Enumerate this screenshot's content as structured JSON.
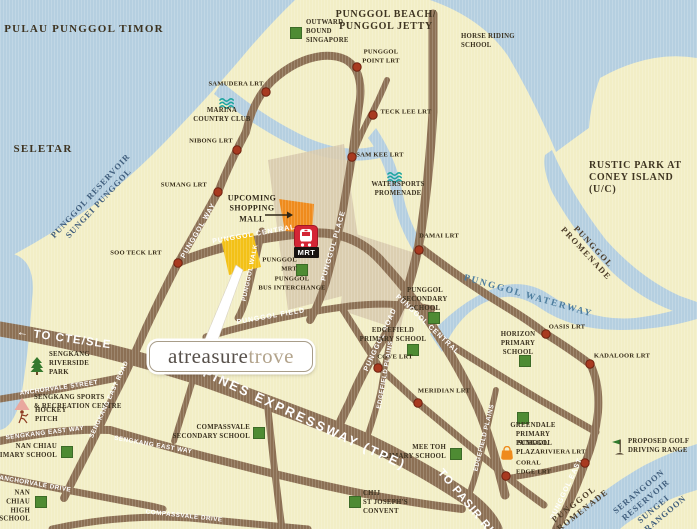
{
  "logo": {
    "part1": "atreasure",
    "part2": "trove"
  },
  "mrt_badge": "MRT",
  "colors": {
    "water": "#b5cfe0",
    "land": "#f2eec6",
    "road": "#8c7054",
    "town_block": "#d9cbae",
    "site_yellow": "#f3c117",
    "mall_orange": "#ef8b1d",
    "lrt_red": "#a83a20",
    "school_green": "#4e8b33",
    "mrt_red": "#d42535",
    "logo_text": "#57504a",
    "logo_trove": "#b3a48c"
  },
  "labels": [
    {
      "id": "pulau-punggol-timor",
      "text": "PULAU PUNGGOL TIMOR",
      "x": 84,
      "y": 30,
      "rotate": 0,
      "cls": "place-lg",
      "align": "center"
    },
    {
      "id": "punggol-beach-jetty",
      "text": "PUNGGOL BEACH/\nPUNGGOL JETTY",
      "x": 386,
      "y": 21,
      "rotate": 0,
      "cls": "place-md",
      "align": "center"
    },
    {
      "id": "outward-bound",
      "text": "OUTWARD\nBOUND\nSINGAPORE",
      "x": 306,
      "y": 32,
      "rotate": 0,
      "cls": "poi",
      "align": "left"
    },
    {
      "id": "horse-riding-school",
      "text": "HORSE RIDING\nSCHOOL",
      "x": 461,
      "y": 42,
      "rotate": 0,
      "cls": "poi",
      "align": "left"
    },
    {
      "id": "punggol-point-lrt",
      "text": "PUNGGOL\nPOINT LRT",
      "x": 381,
      "y": 57,
      "rotate": 0,
      "cls": "lrt",
      "align": "center"
    },
    {
      "id": "samudera-lrt",
      "text": "SAMUDERA LRT",
      "x": 236,
      "y": 85,
      "rotate": 0,
      "cls": "lrt",
      "align": "center"
    },
    {
      "id": "marina-country-club",
      "text": "MARINA\nCOUNTRY CLUB",
      "x": 222,
      "y": 116,
      "rotate": 0,
      "cls": "poi",
      "align": "center"
    },
    {
      "id": "teck-lee-lrt",
      "text": "TECK LEE LRT",
      "x": 406,
      "y": 113,
      "rotate": 0,
      "cls": "lrt",
      "align": "center"
    },
    {
      "id": "nibong-lrt",
      "text": "NIBONG LRT",
      "x": 211,
      "y": 142,
      "rotate": 0,
      "cls": "lrt",
      "align": "center"
    },
    {
      "id": "sam-kee-lrt",
      "text": "SAM KEE LRT",
      "x": 380,
      "y": 156,
      "rotate": 0,
      "cls": "lrt",
      "align": "center"
    },
    {
      "id": "seletar",
      "text": "SELETAR",
      "x": 43,
      "y": 150,
      "rotate": 0,
      "cls": "place-lg",
      "align": "center"
    },
    {
      "id": "rustic-park-coney",
      "text": "RUSTIC PARK AT\nCONEY ISLAND\n(U/C)",
      "x": 589,
      "y": 178,
      "rotate": 0,
      "cls": "place-md",
      "align": "left"
    },
    {
      "id": "punggol-reservoir",
      "text": "PUNGGOL RESERVOIR\nSUNGEI PUNGGOL",
      "x": 95,
      "y": 200,
      "rotate": -47,
      "cls": "water",
      "align": "center"
    },
    {
      "id": "sumang-lrt",
      "text": "SUMANG LRT",
      "x": 207,
      "y": 186,
      "rotate": 0,
      "cls": "lrt",
      "align": "right"
    },
    {
      "id": "watersports-promenade",
      "text": "WATERSPORTS\nPROMENADE",
      "x": 398,
      "y": 190,
      "rotate": 0,
      "cls": "poi",
      "align": "center"
    },
    {
      "id": "upcoming-mall",
      "text": "UPCOMING\nSHOPPING\nMALL",
      "x": 252,
      "y": 209,
      "rotate": 0,
      "cls": "poi-lg",
      "align": "center"
    },
    {
      "id": "punggol-way-road",
      "text": "PUNGGOL WAY",
      "x": 199,
      "y": 231,
      "rotate": -60,
      "cls": "road",
      "align": "center"
    },
    {
      "id": "punggol-central-road-1",
      "text": "PUNGGOL CENTRAL",
      "x": 254,
      "y": 235,
      "rotate": -10,
      "cls": "road",
      "align": "center"
    },
    {
      "id": "soo-teck-lrt",
      "text": "SOO TECK LRT",
      "x": 136,
      "y": 254,
      "rotate": 0,
      "cls": "lrt",
      "align": "center"
    },
    {
      "id": "punggol-place-road",
      "text": "PUNGGOL PLACE",
      "x": 334,
      "y": 246,
      "rotate": -74,
      "cls": "road",
      "align": "center"
    },
    {
      "id": "damai-lrt",
      "text": "DAMAI LRT",
      "x": 439,
      "y": 237,
      "rotate": 0,
      "cls": "lrt",
      "align": "center"
    },
    {
      "id": "punggol-promenade-1",
      "text": "PUNGGOL PROMENADE",
      "x": 590,
      "y": 250,
      "rotate": 47,
      "cls": "promenade",
      "align": "center"
    },
    {
      "id": "punggol-waterway",
      "text": "PUNGGOL WATERWAY",
      "x": 528,
      "y": 297,
      "rotate": 16,
      "cls": "water-way",
      "align": "center"
    },
    {
      "id": "punggol-mrt",
      "text": "PUNGGOL\nMRT",
      "x": 297,
      "y": 265,
      "rotate": 0,
      "cls": "lrt",
      "align": "right"
    },
    {
      "id": "punggol-bus-interchange",
      "text": "PUNGGOL\nBUS INTERCHANGE",
      "x": 292,
      "y": 284,
      "rotate": 0,
      "cls": "lrt",
      "align": "center"
    },
    {
      "id": "punggol-walk-road",
      "text": "PUNGGOL WALK",
      "x": 251,
      "y": 273,
      "rotate": -78,
      "cls": "road-sm",
      "align": "center"
    },
    {
      "id": "punggol-field-road",
      "text": "PUNGGOL FIELD",
      "x": 271,
      "y": 317,
      "rotate": -10,
      "cls": "road",
      "align": "center"
    },
    {
      "id": "punggol-secondary-school",
      "text": "PUNGGOL\nSECONDARY\nSCHOOL",
      "x": 425,
      "y": 300,
      "rotate": 0,
      "cls": "poi",
      "align": "center"
    },
    {
      "id": "punggol-road-label",
      "text": "PUNGGOL ROAD",
      "x": 381,
      "y": 340,
      "rotate": -65,
      "cls": "road",
      "align": "center"
    },
    {
      "id": "punggol-central-road-2",
      "text": "PUNGGOL CENTRAL",
      "x": 427,
      "y": 325,
      "rotate": 43,
      "cls": "road",
      "align": "center"
    },
    {
      "id": "edgefield-primary-school",
      "text": "EDGEFIELD\nPRIMARY SCHOOL",
      "x": 393,
      "y": 336,
      "rotate": 0,
      "cls": "poi",
      "align": "center"
    },
    {
      "id": "cove-lrt",
      "text": "COVE LRT",
      "x": 395,
      "y": 358,
      "rotate": 0,
      "cls": "lrt",
      "align": "center"
    },
    {
      "id": "oasis-lrt",
      "text": "OASIS LRT",
      "x": 567,
      "y": 328,
      "rotate": 0,
      "cls": "lrt",
      "align": "center"
    },
    {
      "id": "horizon-primary-school",
      "text": "HORIZON\nPRIMARY\nSCHOOL",
      "x": 518,
      "y": 344,
      "rotate": 0,
      "cls": "poi",
      "align": "center"
    },
    {
      "id": "kadaloor-lrt",
      "text": "KADALOOR LRT",
      "x": 622,
      "y": 357,
      "rotate": 0,
      "cls": "lrt",
      "align": "center"
    },
    {
      "id": "edgefield-plains-road-1",
      "text": "EDGEFIELD PLAINS",
      "x": 386,
      "y": 375,
      "rotate": -80,
      "cls": "road-sm",
      "align": "center"
    },
    {
      "id": "meridian-lrt",
      "text": "MERIDIAN LRT",
      "x": 444,
      "y": 392,
      "rotate": 0,
      "cls": "lrt",
      "align": "center"
    },
    {
      "id": "edgefield-plains-road-2",
      "text": "EDGEFIELD PLAINS",
      "x": 485,
      "y": 438,
      "rotate": -76,
      "cls": "road-sm",
      "align": "center"
    },
    {
      "id": "greendale-primary-school",
      "text": "GREENDALE\nPRIMARY\nSCHOOL",
      "x": 533,
      "y": 435,
      "rotate": 0,
      "cls": "poi",
      "align": "center"
    },
    {
      "id": "mee-toh-primary-school",
      "text": "MEE TOH\nPRIMARY SCHOOL",
      "x": 446,
      "y": 453,
      "rotate": 0,
      "cls": "poi",
      "align": "right"
    },
    {
      "id": "punggol-plaza",
      "text": "PUNGGOL\nPLAZA",
      "x": 516,
      "y": 449,
      "rotate": 0,
      "cls": "poi",
      "align": "left"
    },
    {
      "id": "riviera-lrt",
      "text": "RIVIERA LRT",
      "x": 563,
      "y": 453,
      "rotate": 0,
      "cls": "lrt",
      "align": "center"
    },
    {
      "id": "coral-edge-lrt",
      "text": "CORAL\nEDGE LRT",
      "x": 516,
      "y": 468,
      "rotate": 0,
      "cls": "lrt",
      "align": "left"
    },
    {
      "id": "proposed-golf-driving-range",
      "text": "PROPOSED GOLF\nDRIVING RANGE",
      "x": 628,
      "y": 447,
      "rotate": 0,
      "cls": "poi",
      "align": "left"
    },
    {
      "id": "punggol-east-road",
      "text": "PUNGGOL EAST",
      "x": 567,
      "y": 489,
      "rotate": -65,
      "cls": "road",
      "align": "center"
    },
    {
      "id": "punggol-promenade-2",
      "text": "PUNGGOL PROMENADE",
      "x": 577,
      "y": 508,
      "rotate": -38,
      "cls": "promenade",
      "align": "center"
    },
    {
      "id": "serangoon-reservoir",
      "text": "SERANGOON RESERVOIR\nSUNGEI SERANGOON",
      "x": 650,
      "y": 505,
      "rotate": -40,
      "cls": "water",
      "align": "center"
    },
    {
      "id": "tampines-expressway",
      "text": "TAMPINES EXPRESSWAY (TPE)",
      "x": 289,
      "y": 412,
      "rotate": 25,
      "cls": "road-lg",
      "align": "center"
    },
    {
      "id": "to-cte-sle",
      "text": "← TO CTE/SLE",
      "x": 64,
      "y": 339,
      "rotate": 8,
      "cls": "road-md",
      "align": "center"
    },
    {
      "id": "to-pasir-ris",
      "text": "TO PASIR RIS",
      "x": 468,
      "y": 505,
      "rotate": 50,
      "cls": "road-md",
      "align": "center"
    },
    {
      "id": "sengkang-riverside-park",
      "text": "SENGKANG\nRIVERSIDE\nPARK",
      "x": 49,
      "y": 364,
      "rotate": 0,
      "cls": "poi",
      "align": "left"
    },
    {
      "id": "anchorvale-street-road",
      "text": "ANCHORVALE STREET",
      "x": 59,
      "y": 389,
      "rotate": -8,
      "cls": "road-sm",
      "align": "center"
    },
    {
      "id": "sengkang-sports-centre",
      "text": "SENGKANG SPORTS\n& RECREATION CENTRE",
      "x": 34,
      "y": 403,
      "rotate": 0,
      "cls": "poi",
      "align": "left"
    },
    {
      "id": "hockey-pitch",
      "text": "HOCKEY\nPITCH",
      "x": 35,
      "y": 416,
      "rotate": 0,
      "cls": "poi",
      "align": "left"
    },
    {
      "id": "sengkang-east-way-road-1",
      "text": "SENGKANG EAST WAY",
      "x": 45,
      "y": 434,
      "rotate": -7,
      "cls": "road-sm",
      "align": "center"
    },
    {
      "id": "sengkang-east-road",
      "text": "SENGKANG EAST ROAD",
      "x": 110,
      "y": 400,
      "rotate": -65,
      "cls": "road-sm",
      "align": "center"
    },
    {
      "id": "compassvale-secondary-school",
      "text": "COMPASSVALE\nSECONDARY SCHOOL",
      "x": 250,
      "y": 433,
      "rotate": 0,
      "cls": "poi",
      "align": "right"
    },
    {
      "id": "nan-chiau-primary-school",
      "text": "NAN CHIAU\nPRIMARY SCHOOL",
      "x": 57,
      "y": 452,
      "rotate": 0,
      "cls": "poi",
      "align": "right"
    },
    {
      "id": "sengkang-east-way-road-2",
      "text": "SENGKANG EAST WAY",
      "x": 153,
      "y": 446,
      "rotate": 10,
      "cls": "road-sm",
      "align": "center"
    },
    {
      "id": "anchorvale-drive-road",
      "text": "ANCHORVALE DRIVE",
      "x": 35,
      "y": 485,
      "rotate": 10,
      "cls": "road-sm",
      "align": "center"
    },
    {
      "id": "nan-chiau-high-school",
      "text": "NAN\nCHIAU\nHIGH\nSCHOOL",
      "x": 30,
      "y": 507,
      "rotate": 0,
      "cls": "poi",
      "align": "right"
    },
    {
      "id": "compassvale-drive-road",
      "text": "COMPASSVALE DRIVE",
      "x": 184,
      "y": 517,
      "rotate": 6,
      "cls": "road-sm",
      "align": "center"
    },
    {
      "id": "chij-st-josephs-convent",
      "text": "CHIJ\nST JOSEPH'S\nCONVENT",
      "x": 363,
      "y": 503,
      "rotate": 0,
      "cls": "poi",
      "align": "left"
    }
  ],
  "markers": [
    {
      "id": "punggol-point-lrt-dot",
      "type": "lrt",
      "x": 357,
      "y": 67
    },
    {
      "id": "samudera-lrt-dot",
      "type": "lrt",
      "x": 266,
      "y": 92
    },
    {
      "id": "teck-lee-lrt-dot",
      "type": "lrt",
      "x": 373,
      "y": 115
    },
    {
      "id": "nibong-lrt-dot",
      "type": "lrt",
      "x": 237,
      "y": 150
    },
    {
      "id": "sam-kee-lrt-dot",
      "type": "lrt",
      "x": 352,
      "y": 157
    },
    {
      "id": "sumang-lrt-dot",
      "type": "lrt",
      "x": 218,
      "y": 192
    },
    {
      "id": "soo-teck-lrt-dot",
      "type": "lrt",
      "x": 178,
      "y": 263
    },
    {
      "id": "damai-lrt-dot",
      "type": "lrt",
      "x": 419,
      "y": 250
    },
    {
      "id": "oasis-lrt-dot",
      "type": "lrt",
      "x": 546,
      "y": 334
    },
    {
      "id": "kadaloor-lrt-dot",
      "type": "lrt",
      "x": 590,
      "y": 364
    },
    {
      "id": "cove-lrt-dot",
      "type": "lrt",
      "x": 378,
      "y": 368
    },
    {
      "id": "meridian-lrt-dot",
      "type": "lrt",
      "x": 418,
      "y": 403
    },
    {
      "id": "coral-edge-lrt-dot",
      "type": "lrt",
      "x": 506,
      "y": 476
    },
    {
      "id": "riviera-lrt-dot",
      "type": "lrt",
      "x": 585,
      "y": 463
    },
    {
      "id": "outward-bound-marker",
      "type": "school",
      "x": 296,
      "y": 33
    },
    {
      "id": "punggol-secondary-marker",
      "type": "school",
      "x": 434,
      "y": 318
    },
    {
      "id": "edgefield-primary-marker",
      "type": "school",
      "x": 413,
      "y": 350
    },
    {
      "id": "horizon-primary-marker",
      "type": "school",
      "x": 525,
      "y": 361
    },
    {
      "id": "greendale-primary-marker",
      "type": "school",
      "x": 523,
      "y": 418
    },
    {
      "id": "mee-toh-marker",
      "type": "school",
      "x": 456,
      "y": 454
    },
    {
      "id": "compassvale-secondary-marker",
      "type": "school",
      "x": 259,
      "y": 433
    },
    {
      "id": "nan-chiau-primary-marker",
      "type": "school",
      "x": 67,
      "y": 452
    },
    {
      "id": "nan-chiau-high-marker",
      "type": "school",
      "x": 41,
      "y": 502
    },
    {
      "id": "chij-marker",
      "type": "school",
      "x": 355,
      "y": 502
    },
    {
      "id": "bus-interchange-marker",
      "type": "school",
      "x": 302,
      "y": 270
    },
    {
      "id": "marina-waves-icon",
      "type": "waves",
      "x": 228,
      "y": 103
    },
    {
      "id": "watersports-waves-icon",
      "type": "waves",
      "x": 396,
      "y": 177
    },
    {
      "id": "riverside-park-tree-icon",
      "type": "tree",
      "x": 37,
      "y": 366
    },
    {
      "id": "sports-centre-triangle-icon",
      "type": "triangle",
      "x": 22,
      "y": 404
    },
    {
      "id": "hockey-player-icon",
      "type": "hockey",
      "x": 23,
      "y": 417
    },
    {
      "id": "golf-flag-icon",
      "type": "golf",
      "x": 618,
      "y": 447
    },
    {
      "id": "punggol-plaza-bag-icon",
      "type": "bag",
      "x": 507,
      "y": 453
    },
    {
      "id": "punggol-mrt-icon",
      "type": "mrt",
      "x": 306,
      "y": 237
    },
    {
      "id": "mall-arrow-icon",
      "type": "arrow",
      "x": 279,
      "y": 215
    }
  ]
}
